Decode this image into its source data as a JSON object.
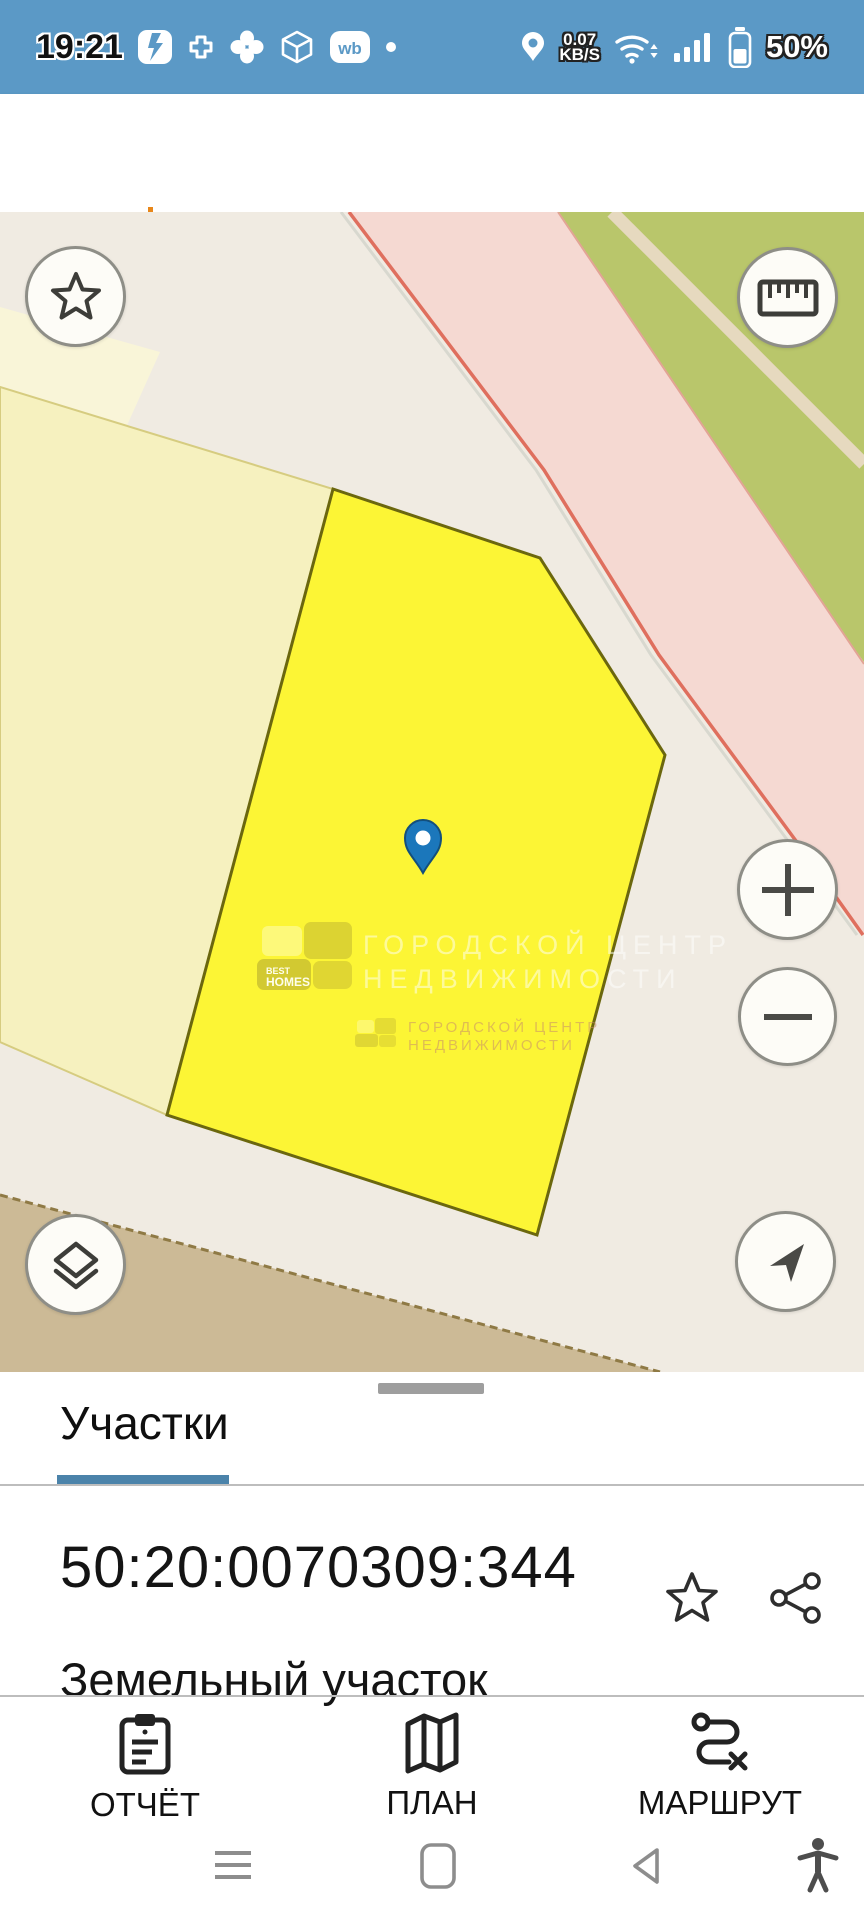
{
  "status_bar": {
    "time": "19:21",
    "data_rate": "0.07",
    "data_rate_unit": "KB/S",
    "battery_percent": "50%",
    "bg_color": "#5b99c6"
  },
  "search": {
    "placeholder": "Поиск",
    "menu_color": "#1b74a8"
  },
  "map": {
    "watermark": {
      "logo_line1": "BEST",
      "logo_line2": "HOMES",
      "line1": "ГОРОДСКОЙ ЦЕНТР",
      "line2": "НЕДВИЖИМОСТИ"
    },
    "colors": {
      "background": "#f0ebe2",
      "selected_parcel": "#fcf535",
      "selected_parcel_border": "#6b670e",
      "pale_parcel": "#f6f1bf",
      "green_area": "#b9c66b",
      "pink_area": "#f5d9d2",
      "road_line": "#df6f5e",
      "tan_area": "#ccba96",
      "pin": "#1b77bb"
    }
  },
  "sheet": {
    "tab_label": "Участки",
    "parcel_number": "50:20:0070309:344",
    "parcel_type": "Земельный участок",
    "actions": [
      {
        "label": "ОТЧЁТ"
      },
      {
        "label": "ПЛАН"
      },
      {
        "label": "МАРШРУТ"
      }
    ]
  }
}
